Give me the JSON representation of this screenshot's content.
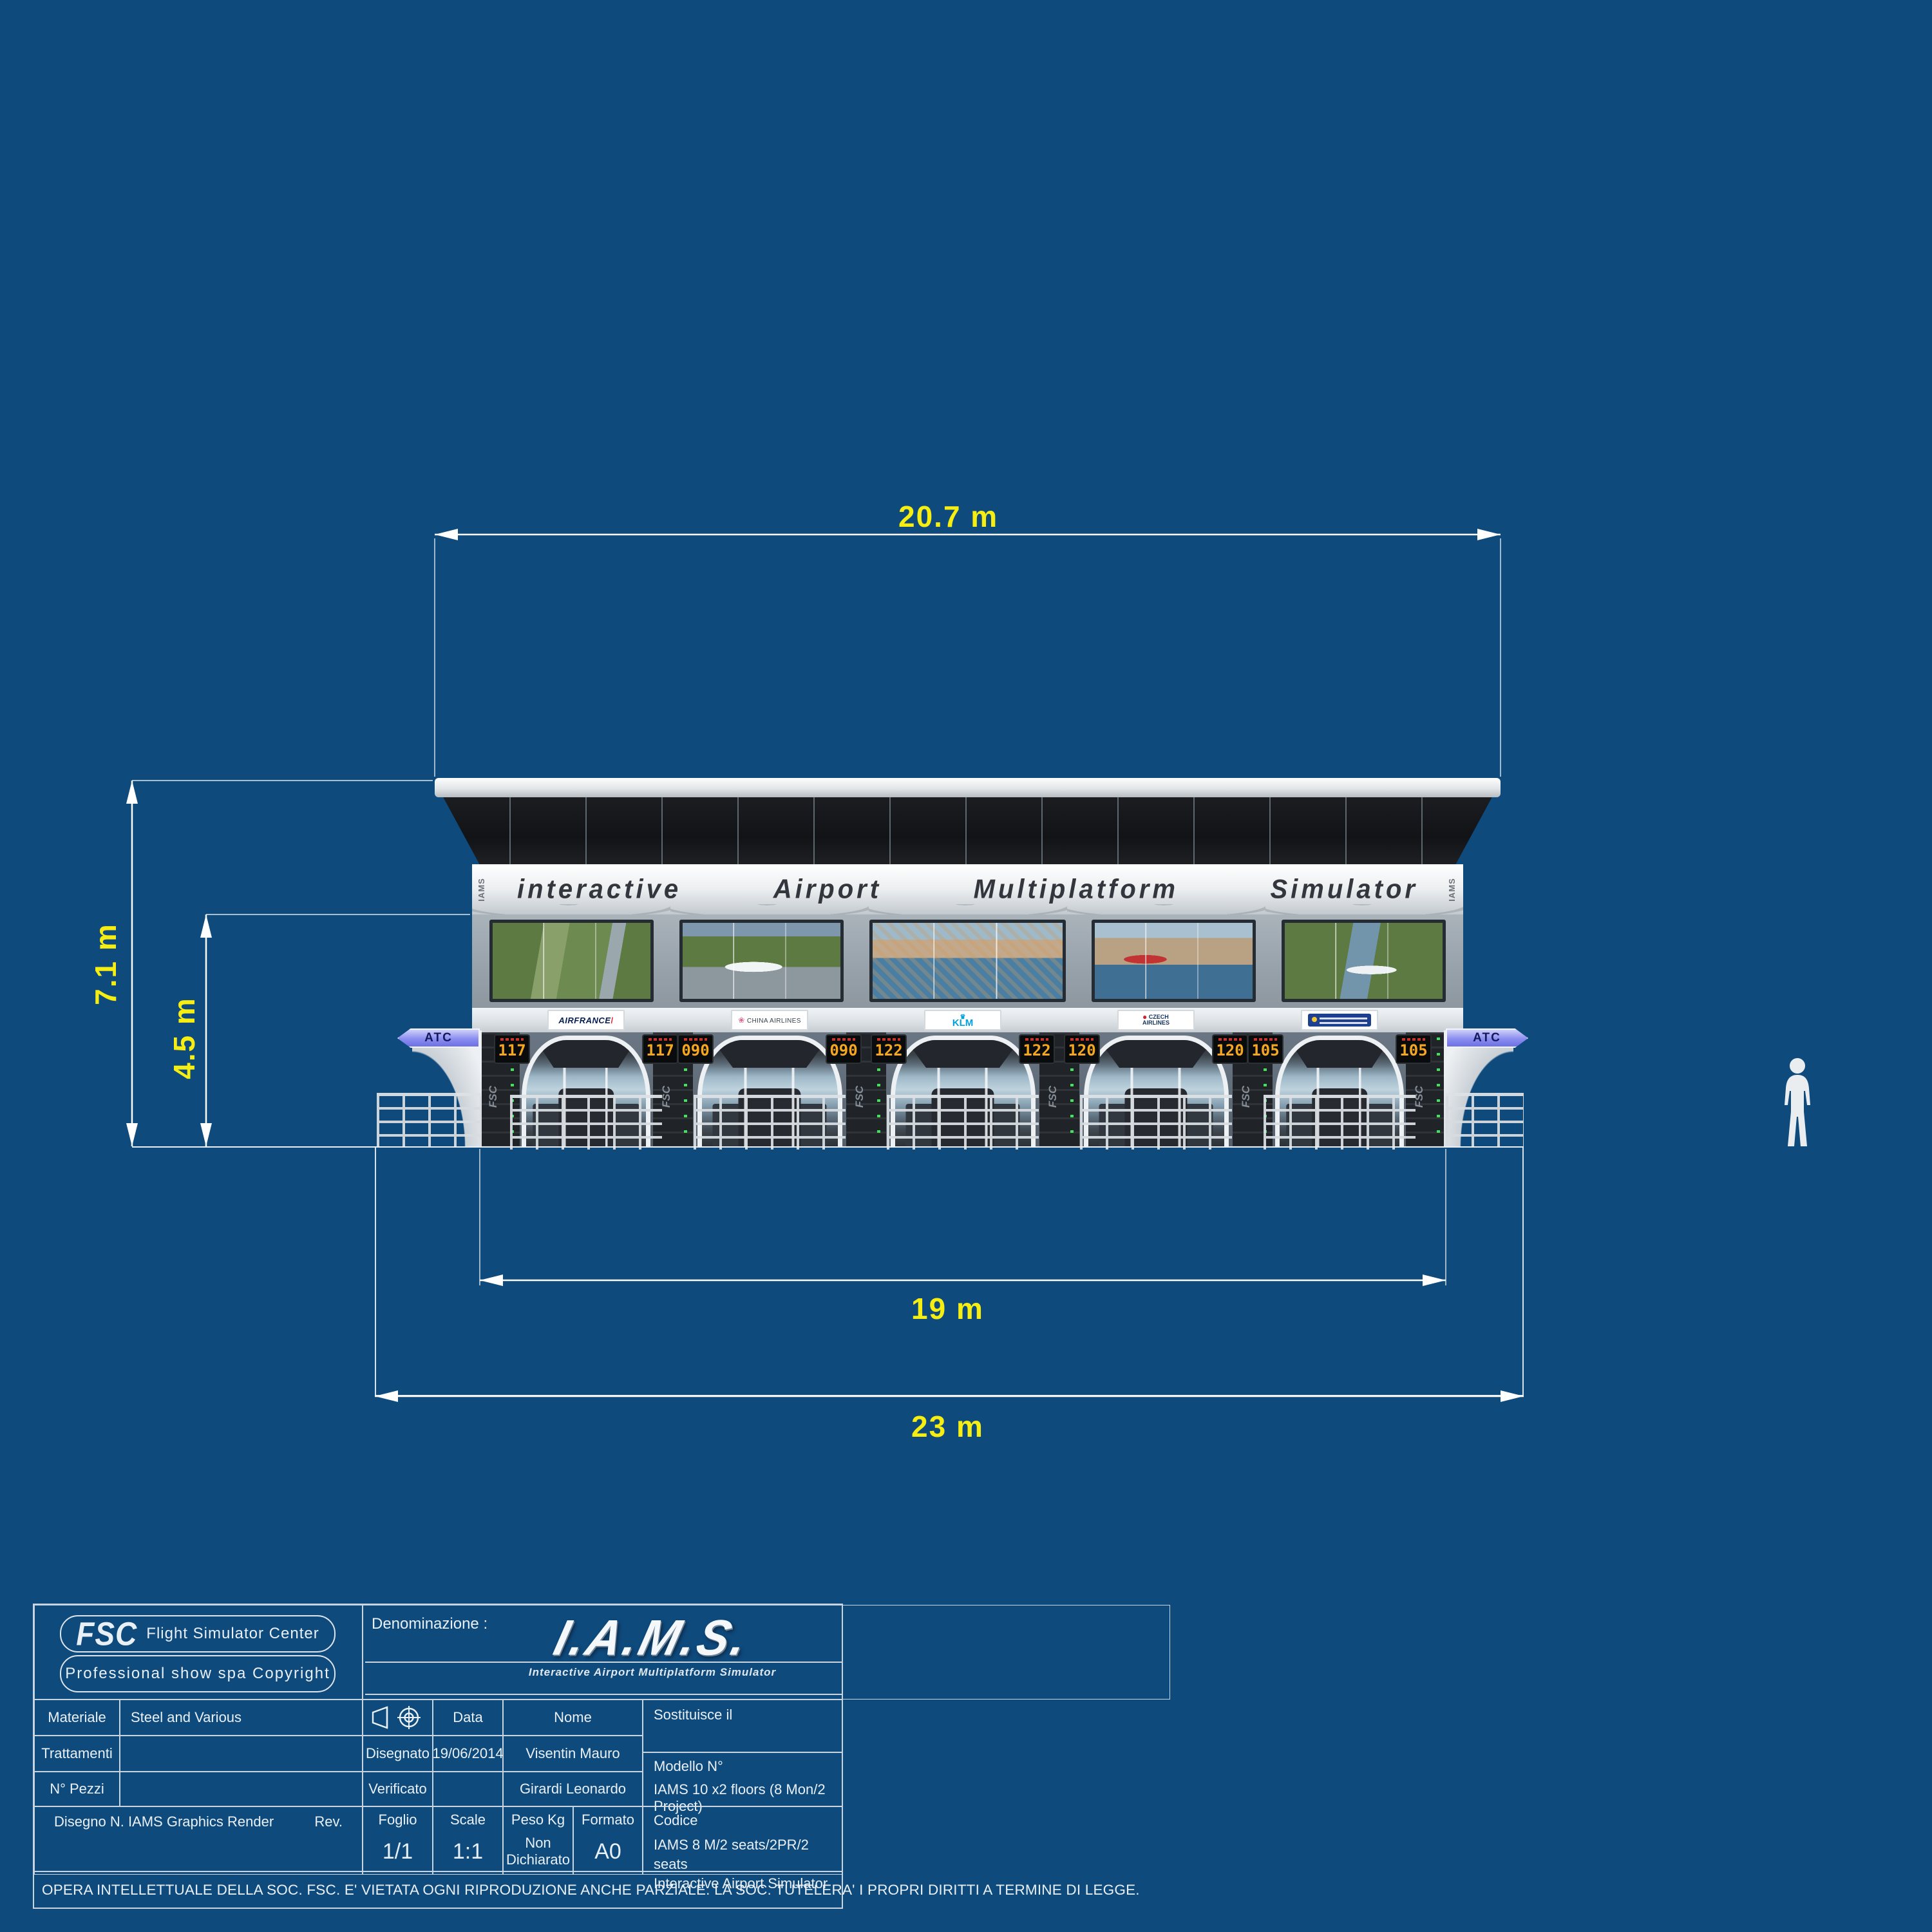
{
  "sheet": {
    "background_color": "#0f4a7d",
    "dimension_color": "#f6ee12",
    "line_color": "#ffffff"
  },
  "dimensions": {
    "roof_width": "20.7 m",
    "total_height": "7.1 m",
    "facade_height": "4.5 m",
    "body_width": "19 m",
    "platform_width": "23 m"
  },
  "building": {
    "banner_words": [
      "interactive",
      "Airport",
      "Multiplatform",
      "Simulator"
    ],
    "side_mark": "IAMS",
    "atc_label": "ATC",
    "rack_logo": "FSC",
    "bays": [
      {
        "airline": "AIRFRANCE",
        "display": "117"
      },
      {
        "airline": "CHINA AIRLINES",
        "display": "090"
      },
      {
        "airline": "KLM",
        "display": "122"
      },
      {
        "airline": "CZECH AIRLINES",
        "display": "120"
      },
      {
        "airline": "",
        "display": "105"
      }
    ]
  },
  "title_block": {
    "fsc_logo": "FSC",
    "fsc_tagline": "Flight Simulator Center",
    "copyright_pill": "Professional show spa Copyright",
    "denominazione_label": "Denominazione :",
    "product_logo": "I.A.M.S.",
    "product_subtitle": "Interactive Airport Multiplatform Simulator",
    "materiale_label": "Materiale",
    "materiale_value": "Steel and Various",
    "trattamenti_label": "Trattamenti",
    "trattamenti_value": "",
    "pezzi_label": "N° Pezzi",
    "pezzi_value": "",
    "data_label": "Data",
    "nome_label": "Nome",
    "sostituisce_label": "Sostituisce il",
    "disegnato_label": "Disegnato",
    "disegnato_data": "19/06/2014",
    "disegnato_nome": "Visentin Mauro",
    "verificato_label": "Verificato",
    "verificato_data": "",
    "verificato_nome": "Girardi Leonardo",
    "modello_label": "Modello N°",
    "modello_value": "IAMS 10 x2 floors (8 Mon/2 Project)",
    "disegno_label": "Disegno N. IAMS Graphics Render",
    "rev_label": "Rev.",
    "foglio_label": "Foglio",
    "foglio_value": "1/1",
    "scale_label": "Scale",
    "scale_value": "1:1",
    "peso_label": "Peso Kg",
    "peso_value_line1": "Non",
    "peso_value_line2": "Dichiarato",
    "formato_label": "Formato",
    "formato_value": "A0",
    "codice_label": "Codice",
    "codice_value_line1": "IAMS 8 M/2 seats/2PR/2 seats",
    "codice_value_line2": "Interactive Airport Simulator",
    "legal": "OPERA INTELLETTUALE DELLA SOC. FSC. E' VIETATA OGNI RIPRODUZIONE ANCHE PARZIALE. LA SOC. TUTELERA' I PROPRI DIRITTI A TERMINE DI LEGGE."
  }
}
